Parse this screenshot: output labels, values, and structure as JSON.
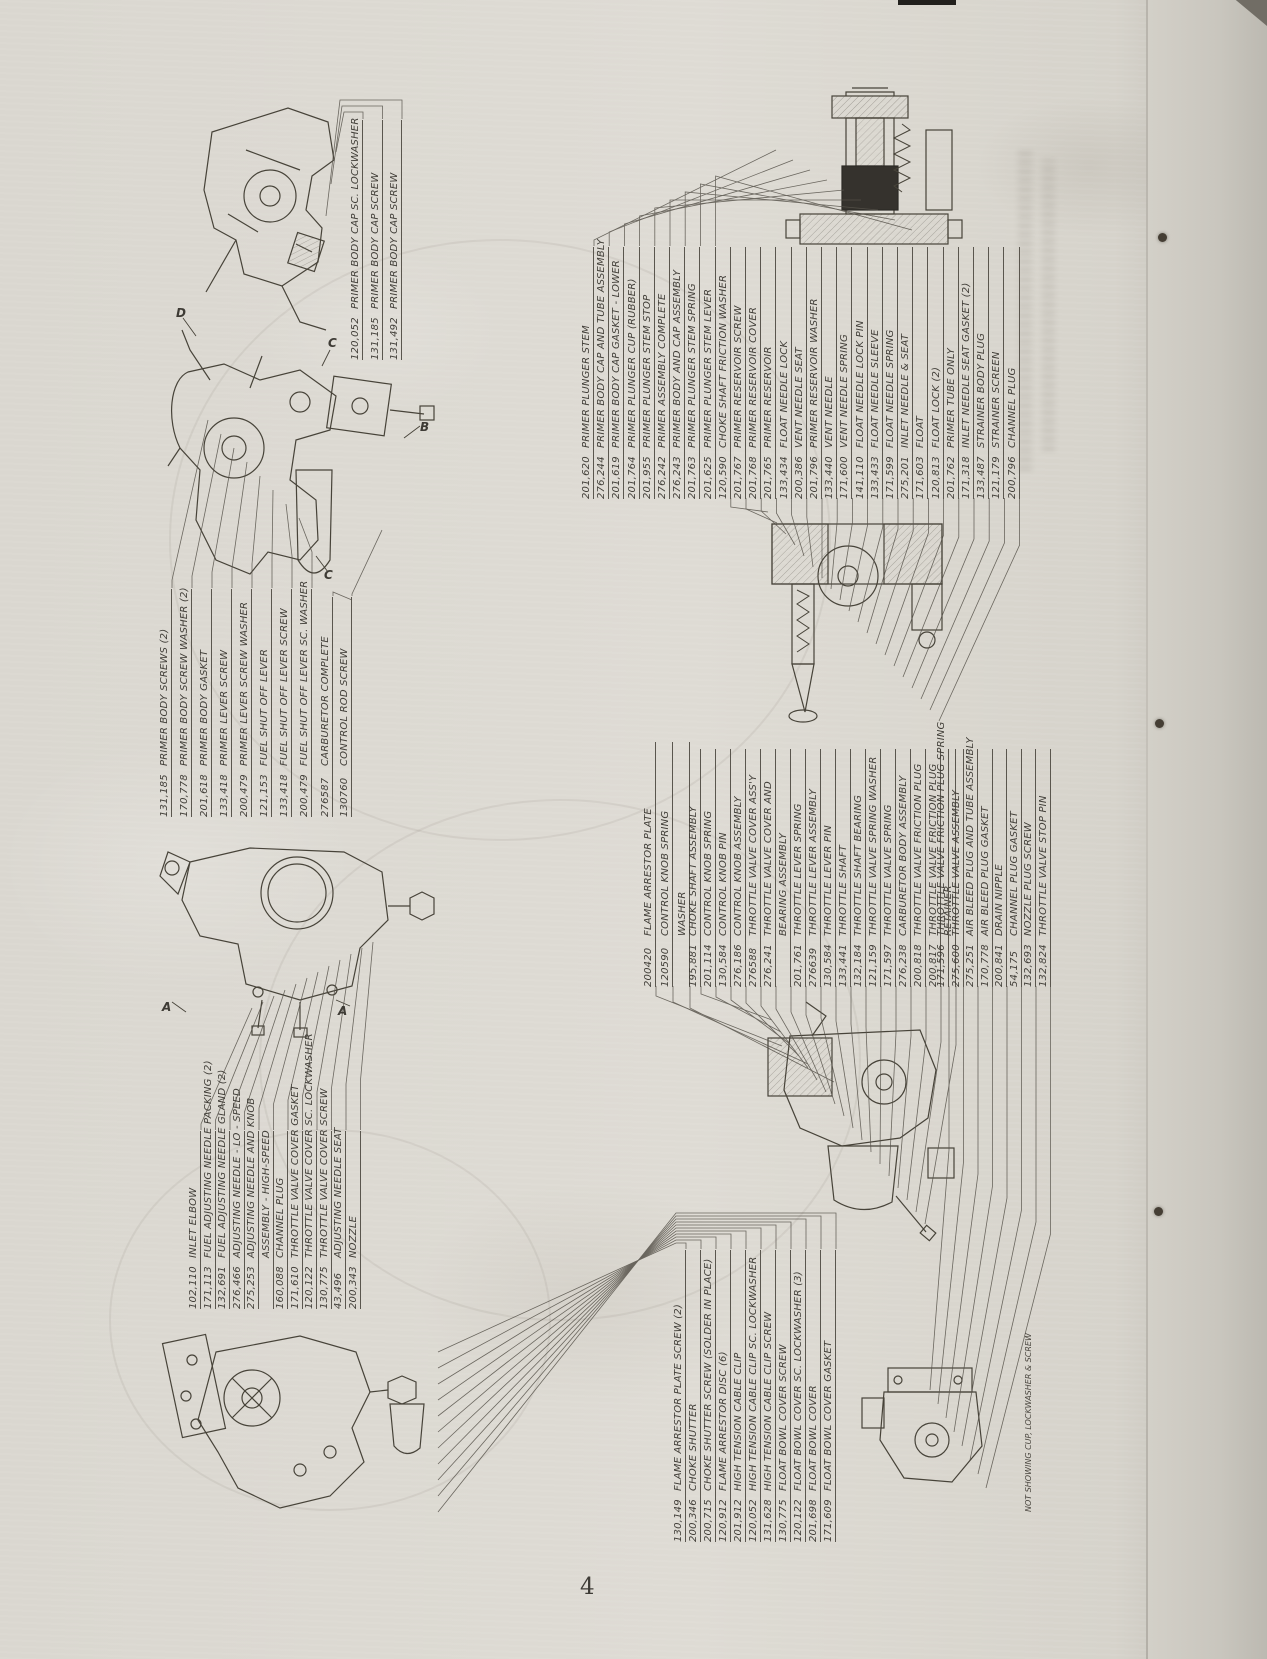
{
  "page": {
    "number": "4"
  },
  "note": "NOT SHOWING CUP, LOCKWASHER & SCREW",
  "markers": [
    "D",
    "C",
    "B",
    "C",
    "A",
    "A"
  ],
  "groups": {
    "primer_cap": {
      "items": [
        {
          "num": "120,052",
          "name": "PRIMER BODY CAP SC. LOCKWASHER"
        },
        {
          "num": "131,185",
          "name": "PRIMER BODY CAP SCREW"
        },
        {
          "num": "131,492",
          "name": "PRIMER BODY CAP SCREW"
        }
      ]
    },
    "primer_body": {
      "items": [
        {
          "num": "131,185",
          "name": "PRIMER BODY SCREWS (2)"
        },
        {
          "num": "170,778",
          "name": "PRIMER BODY SCREW WASHER (2)"
        },
        {
          "num": "201,618",
          "name": "PRIMER BODY GASKET"
        },
        {
          "num": "133,418",
          "name": "PRIMER LEVER SCREW"
        },
        {
          "num": "200,479",
          "name": "PRIMER LEVER SCREW WASHER"
        },
        {
          "num": "121,153",
          "name": "FUEL SHUT OFF LEVER"
        },
        {
          "num": "133,418",
          "name": "FUEL SHUT OFF LEVER SCREW"
        },
        {
          "num": "200,479",
          "name": "FUEL SHUT OFF LEVER SC. WASHER"
        }
      ]
    },
    "carb_complete": {
      "items": [
        {
          "num": "276587",
          "name": "CARBURETOR COMPLETE"
        },
        {
          "num": "130760",
          "name": "CONTROL ROD SCREW"
        }
      ]
    },
    "primer_assembly": {
      "items": [
        {
          "num": "201,620",
          "name": "PRIMER PLUNGER STEM"
        },
        {
          "num": "276,244",
          "name": "PRIMER BODY CAP AND TUBE ASSEMBLY"
        },
        {
          "num": "201,619",
          "name": "PRIMER BODY CAP GASKET - LOWER"
        },
        {
          "num": "201,764",
          "name": "PRIMER PLUNGER CUP (RUBBER)"
        },
        {
          "num": "201,955",
          "name": "PRIMER PLUNGER STEM STOP"
        },
        {
          "num": "276,242",
          "name": "PRIMER ASSEMBLY COMPLETE"
        },
        {
          "num": "276,243",
          "name": "PRIMER BODY AND CAP ASSEMBLY"
        },
        {
          "num": "201,763",
          "name": "PRIMER PLUNGER STEM SPRING"
        },
        {
          "num": "201,625",
          "name": "PRIMER PLUNGER STEM LEVER"
        },
        {
          "num": "120,590",
          "name": "CHOKE SHAFT FRICTION WASHER"
        },
        {
          "num": "201,767",
          "name": "PRIMER RESERVOIR SCREW"
        },
        {
          "num": "201,768",
          "name": "PRIMER RESERVOIR COVER"
        },
        {
          "num": "201,765",
          "name": "PRIMER RESERVOIR"
        },
        {
          "num": "133,434",
          "name": "FLOAT NEEDLE LOCK"
        },
        {
          "num": "200,386",
          "name": "VENT NEEDLE SEAT"
        },
        {
          "num": "201,796",
          "name": "PRIMER RESERVOIR WASHER"
        },
        {
          "num": "133,440",
          "name": "VENT NEEDLE"
        },
        {
          "num": "171,600",
          "name": "VENT NEEDLE SPRING"
        },
        {
          "num": "141,110",
          "name": "FLOAT NEEDLE LOCK PIN"
        },
        {
          "num": "133,433",
          "name": "FLOAT NEEDLE SLEEVE"
        },
        {
          "num": "171,599",
          "name": "FLOAT NEEDLE SPRING"
        },
        {
          "num": "275,201",
          "name": "INLET NEEDLE & SEAT"
        },
        {
          "num": "171,603",
          "name": "FLOAT"
        },
        {
          "num": "120,813",
          "name": "FLOAT LOCK (2)"
        },
        {
          "num": "201,762",
          "name": "PRIMER TUBE ONLY"
        },
        {
          "num": "171,318",
          "name": "INLET NEEDLE SEAT GASKET (2)"
        },
        {
          "num": "133,487",
          "name": "STRAINER BODY PLUG"
        },
        {
          "num": "121,179",
          "name": "STRAINER SCREEN"
        },
        {
          "num": "200,796",
          "name": "CHANNEL PLUG"
        }
      ]
    },
    "flame_header": {
      "items": [
        {
          "num": "200420",
          "name": "FLAME ARRESTOR PLATE"
        },
        {
          "num": "120590",
          "name": "CONTROL KNOB SPRING"
        },
        {
          "num": "",
          "name": "WASHER"
        }
      ]
    },
    "throttle": {
      "items": [
        {
          "num": "195,881",
          "name": "CHOKE SHAFT ASSEMBLY"
        },
        {
          "num": "201,114",
          "name": "CONTROL KNOB SPRING"
        },
        {
          "num": "130,584",
          "name": "CONTROL KNOB PIN"
        },
        {
          "num": "276,186",
          "name": "CONTROL KNOB ASSEMBLY"
        },
        {
          "num": "276588",
          "name": "THROTTLE VALVE COVER ASS'Y"
        },
        {
          "num": "276,241",
          "name": "THROTTLE VALVE COVER AND"
        },
        {
          "num": "",
          "name": "BEARING ASSEMBLY"
        },
        {
          "num": "201,761",
          "name": "THROTTLE LEVER SPRING"
        },
        {
          "num": "276639",
          "name": "THROTTLE LEVER ASSEMBLY"
        },
        {
          "num": "130,584",
          "name": "THROTTLE LEVER PIN"
        },
        {
          "num": "133,441",
          "name": "THROTTLE SHAFT"
        },
        {
          "num": "132,184",
          "name": "THROTTLE SHAFT BEARING"
        },
        {
          "num": "121,159",
          "name": "THROTTLE VALVE SPRING WASHER"
        },
        {
          "num": "171,597",
          "name": "THROTTLE VALVE SPRING"
        },
        {
          "num": "276,238",
          "name": "CARBURETOR BODY ASSEMBLY"
        },
        {
          "num": "200,818",
          "name": "THROTTLE VALVE FRICTION PLUG"
        },
        {
          "num": "200,817",
          "name": "THROTTLE VALVE FRICTION PLUG"
        },
        {
          "num": "",
          "name": "RETAINER"
        }
      ]
    },
    "throttle2": {
      "items": [
        {
          "num": "171,596",
          "name": "THROTTLE VALVE FRICTION PLUG SPRING"
        },
        {
          "num": "275,600",
          "name": "THROTTLE VALVE ASSEMBLY"
        },
        {
          "num": "275,251",
          "name": "AIR BLEED PLUG AND TUBE ASSEMBLY"
        },
        {
          "num": "170,778",
          "name": "AIR BLEED PLUG GASKET"
        },
        {
          "num": "200,841",
          "name": "DRAIN NIPPLE"
        },
        {
          "num": "54,175",
          "name": "CHANNEL PLUG GASKET"
        },
        {
          "num": "132,693",
          "name": "NOZZLE PLUG SCREW"
        },
        {
          "num": "132,824",
          "name": "THROTTLE VALVE STOP PIN"
        }
      ]
    },
    "adjusting": {
      "items": [
        {
          "num": "102,110",
          "name": "INLET ELBOW"
        },
        {
          "num": "171,113",
          "name": "FUEL ADJUSTING NEEDLE PACKING (2)"
        },
        {
          "num": "132,691",
          "name": "FUEL ADJUSTING NEEDLE GLAND (2)"
        },
        {
          "num": "276,466",
          "name": "ADJUSTING NEEDLE - LO - SPEED"
        },
        {
          "num": "275,253",
          "name": "ADJUSTING NEEDLE AND KNOB"
        },
        {
          "num": "",
          "name": "ASSEMBLY - HIGH-SPEED"
        },
        {
          "num": "160,088",
          "name": "CHANNEL PLUG"
        },
        {
          "num": "171,610",
          "name": "THROTTLE VALVE COVER GASKET"
        },
        {
          "num": "120,122",
          "name": "THROTTLE VALVE COVER SC. LOCKWASHER"
        },
        {
          "num": "130,775",
          "name": "THROTTLE VALVE COVER SCREW"
        },
        {
          "num": "43,496",
          "name": "ADJUSTING NEEDLE SEAT"
        },
        {
          "num": "200,343",
          "name": "NOZZLE"
        }
      ]
    },
    "float_bowl": {
      "items": [
        {
          "num": "130,149",
          "name": "FLAME ARRESTOR PLATE SCREW (2)"
        },
        {
          "num": "200,346",
          "name": "CHOKE SHUTTER"
        },
        {
          "num": "200,715",
          "name": "CHOKE SHUTTER SCREW (SOLDER IN PLACE)"
        },
        {
          "num": "120,912",
          "name": "FLAME ARRESTOR DISC (6)"
        },
        {
          "num": "201,912",
          "name": "HIGH TENSION CABLE CLIP"
        },
        {
          "num": "120,052",
          "name": "HIGH TENSION CABLE CLIP SC. LOCKWASHER"
        },
        {
          "num": "131,628",
          "name": "HIGH TENSION CABLE CLIP SCREW"
        },
        {
          "num": "130,775",
          "name": "FLOAT BOWL COVER SCREW"
        },
        {
          "num": "120,122",
          "name": "FLOAT BOWL COVER SC. LOCKWASHER (3)"
        },
        {
          "num": "201,698",
          "name": "FLOAT BOWL COVER"
        },
        {
          "num": "171,609",
          "name": "FLOAT BOWL COVER GASKET"
        }
      ]
    }
  }
}
